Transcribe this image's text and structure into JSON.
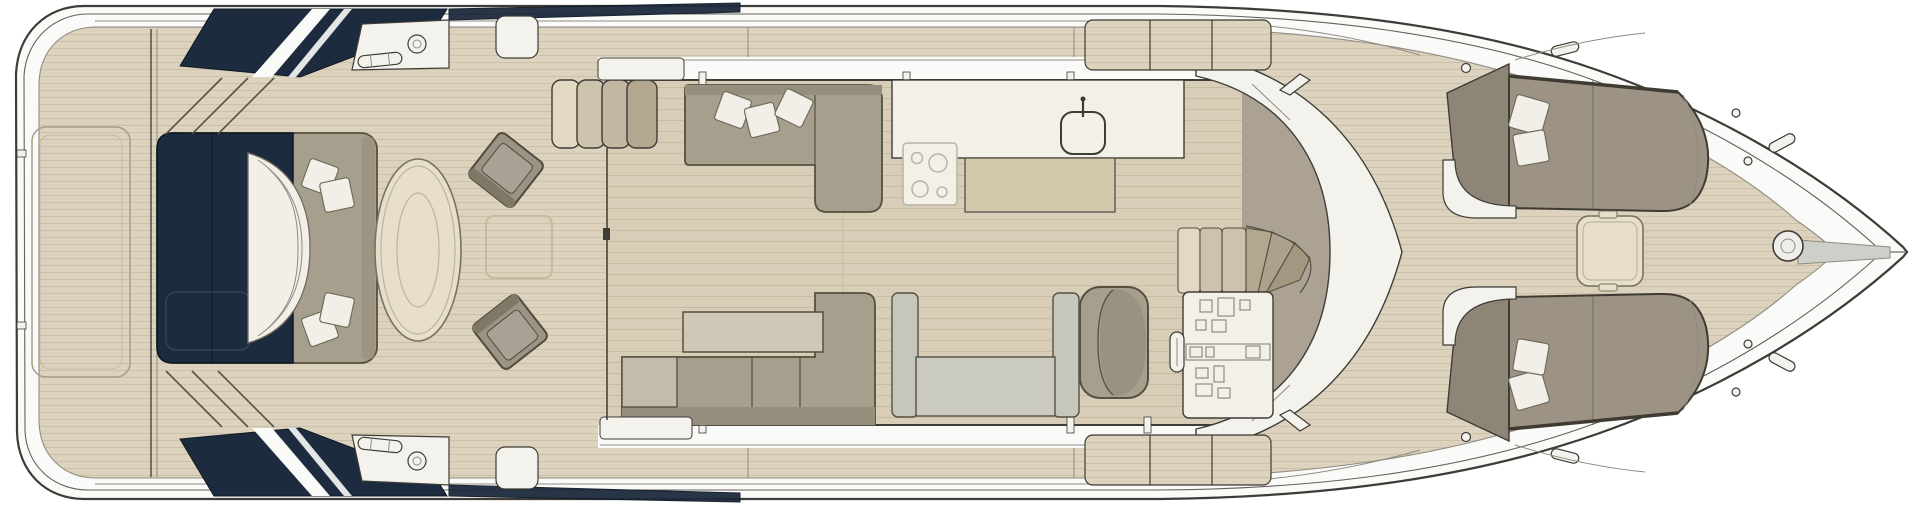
{
  "title": "",
  "visible_text": [],
  "palette": {
    "page_bg": "#ffffff",
    "hull_white": "#fafaf8",
    "outline_dark": "#3e3c36",
    "line_soft": "#8f8c83",
    "deck_teak": "#dcd2bd",
    "deck_plank": "#cbc0a8",
    "salon_floor": "#d8cdb7",
    "salon_plank": "#c6bba3",
    "navy": "#1c2b3d",
    "navy_edge": "#0e1823",
    "navy_panel": "#31435a",
    "white_panel": "#f4f2ec",
    "sofa_taupe": "#a79f8e",
    "sofa_dark": "#968e7d",
    "sofa_border": "#55503f",
    "chaise_light": "#c3bcab",
    "pillow_white": "#f1efe8",
    "pillow_border": "#716c5e",
    "table_beige": "#e7dfcb",
    "table_border": "#77725f",
    "table_inner": "#bdb49d",
    "chair_gray": "#9b9485",
    "chair_seat": "#a8a295",
    "chair_back": "#7e7866",
    "chair_border": "#4f4a3c",
    "dinette_gray": "#c7c6bc",
    "coffee_table": "#cfc8b7",
    "counter_white": "#f3f0e8",
    "counter_tan": "#d4c8ac",
    "cooktop_line": "#b9b4a6",
    "dashboard_taupe": "#aba294",
    "stair_light": "#e2d9c5",
    "stair_mid": "#cdc2ab",
    "stair_dark": "#b3a78f",
    "hatch_faint": "#c6bb9f",
    "chain_gray": "#cfcfca",
    "support_line": "#54524a",
    "bowseat_back": "#8d8676",
    "bowseat_cushion": "#9c9384",
    "bowseat_edge": "#3f3b32"
  },
  "parts": {
    "vessel": "motor-yacht-main-deck-plan",
    "stern_items": [
      "swim-platform",
      "platform-hatch",
      "transom-seat",
      "transom-sunpad-cushion",
      "aft-table",
      "deck-chairs",
      "engine-hatch",
      "hardtop-support-struts",
      "side-deck-overhang-wedges",
      "mooring-cleats"
    ],
    "salon_items": [
      "sliding-door",
      "entry-steps",
      "port-l-sofa",
      "scatter-pillows",
      "galley-counter",
      "cooktop-4-burner",
      "galley-sink",
      "starboard-l-sofa",
      "coffee-table",
      "dinette-table",
      "dinette-benches"
    ],
    "helm_items": [
      "companionway-stairs",
      "helm-console",
      "instrument-panel",
      "steering-wheel",
      "helm-seat",
      "dashboard",
      "wraparound-windshield"
    ],
    "bow_items": [
      "foredeck-steps",
      "bow-sunpad-port",
      "bow-sunpad-starboard",
      "bow-backrests",
      "bow-pillows",
      "bow-table",
      "anchor-windlass",
      "anchor-chain-channel",
      "bow-cleats",
      "fairleads"
    ]
  }
}
